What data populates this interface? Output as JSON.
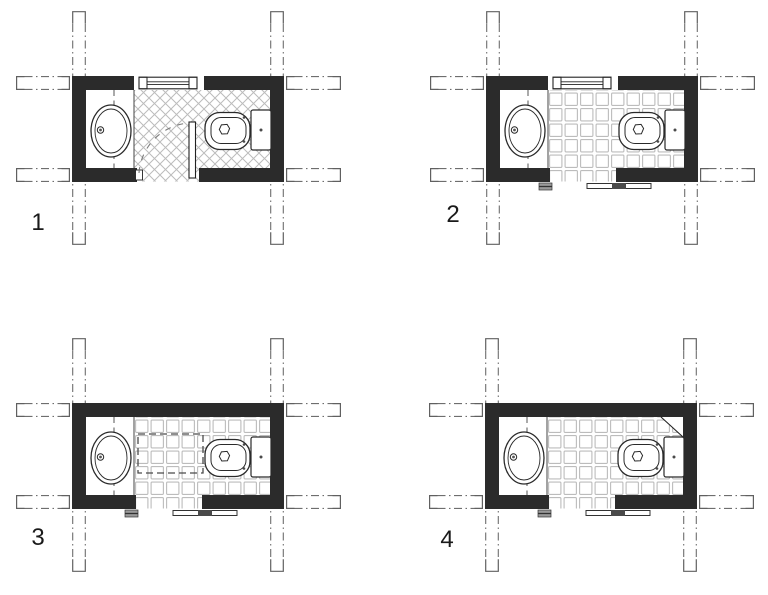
{
  "drawing": {
    "title": "bathroom-floor-plan-variants",
    "background": "#ffffff",
    "colors": {
      "wall": "#2b2b2b",
      "line": "#222222",
      "fixture": "#2a2a2a",
      "tile": "#bcbcbc",
      "grid": "#6e6e6e",
      "grid_cap": "#606060",
      "handle": "#4a4a4a",
      "jamb_fill": "#9a9a9a",
      "arc": "#7a7a7a",
      "label": "#1a1a1a",
      "marking": "#4a4a4a"
    },
    "plans": [
      {
        "label": "1",
        "floor_tiles": "diagonal-hatch",
        "window": true,
        "door": "hinged-inward",
        "fixtures": [
          "washbasin",
          "toilet"
        ]
      },
      {
        "label": "2",
        "floor_tiles": "square-grid",
        "window": true,
        "door": "sliding",
        "fixtures": [
          "washbasin",
          "toilet"
        ]
      },
      {
        "label": "3",
        "floor_tiles": "square-grid",
        "window": false,
        "door": "sliding",
        "fixtures": [
          "washbasin",
          "toilet"
        ],
        "floor_marking": "dashed-rectangle"
      },
      {
        "label": "4",
        "floor_tiles": "square-grid",
        "window": false,
        "door": "sliding",
        "fixtures": [
          "washbasin",
          "toilet"
        ],
        "corner_feature": "diagonal-chase"
      }
    ]
  }
}
